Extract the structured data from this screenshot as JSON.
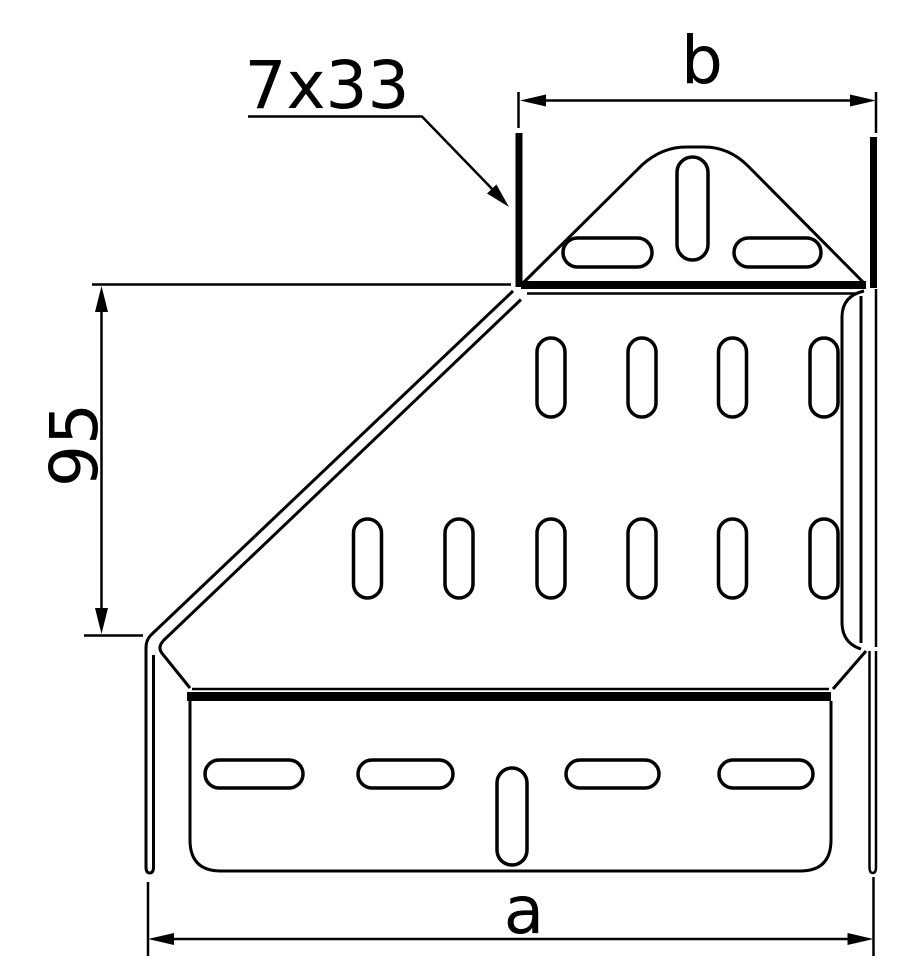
{
  "page": {
    "background": "#ffffff",
    "line_color": "#000000"
  },
  "drawing": {
    "callout_slot_size": "7x33",
    "dim_top_width": "b",
    "dim_slope_height": "95",
    "dim_bottom_width": "a"
  }
}
